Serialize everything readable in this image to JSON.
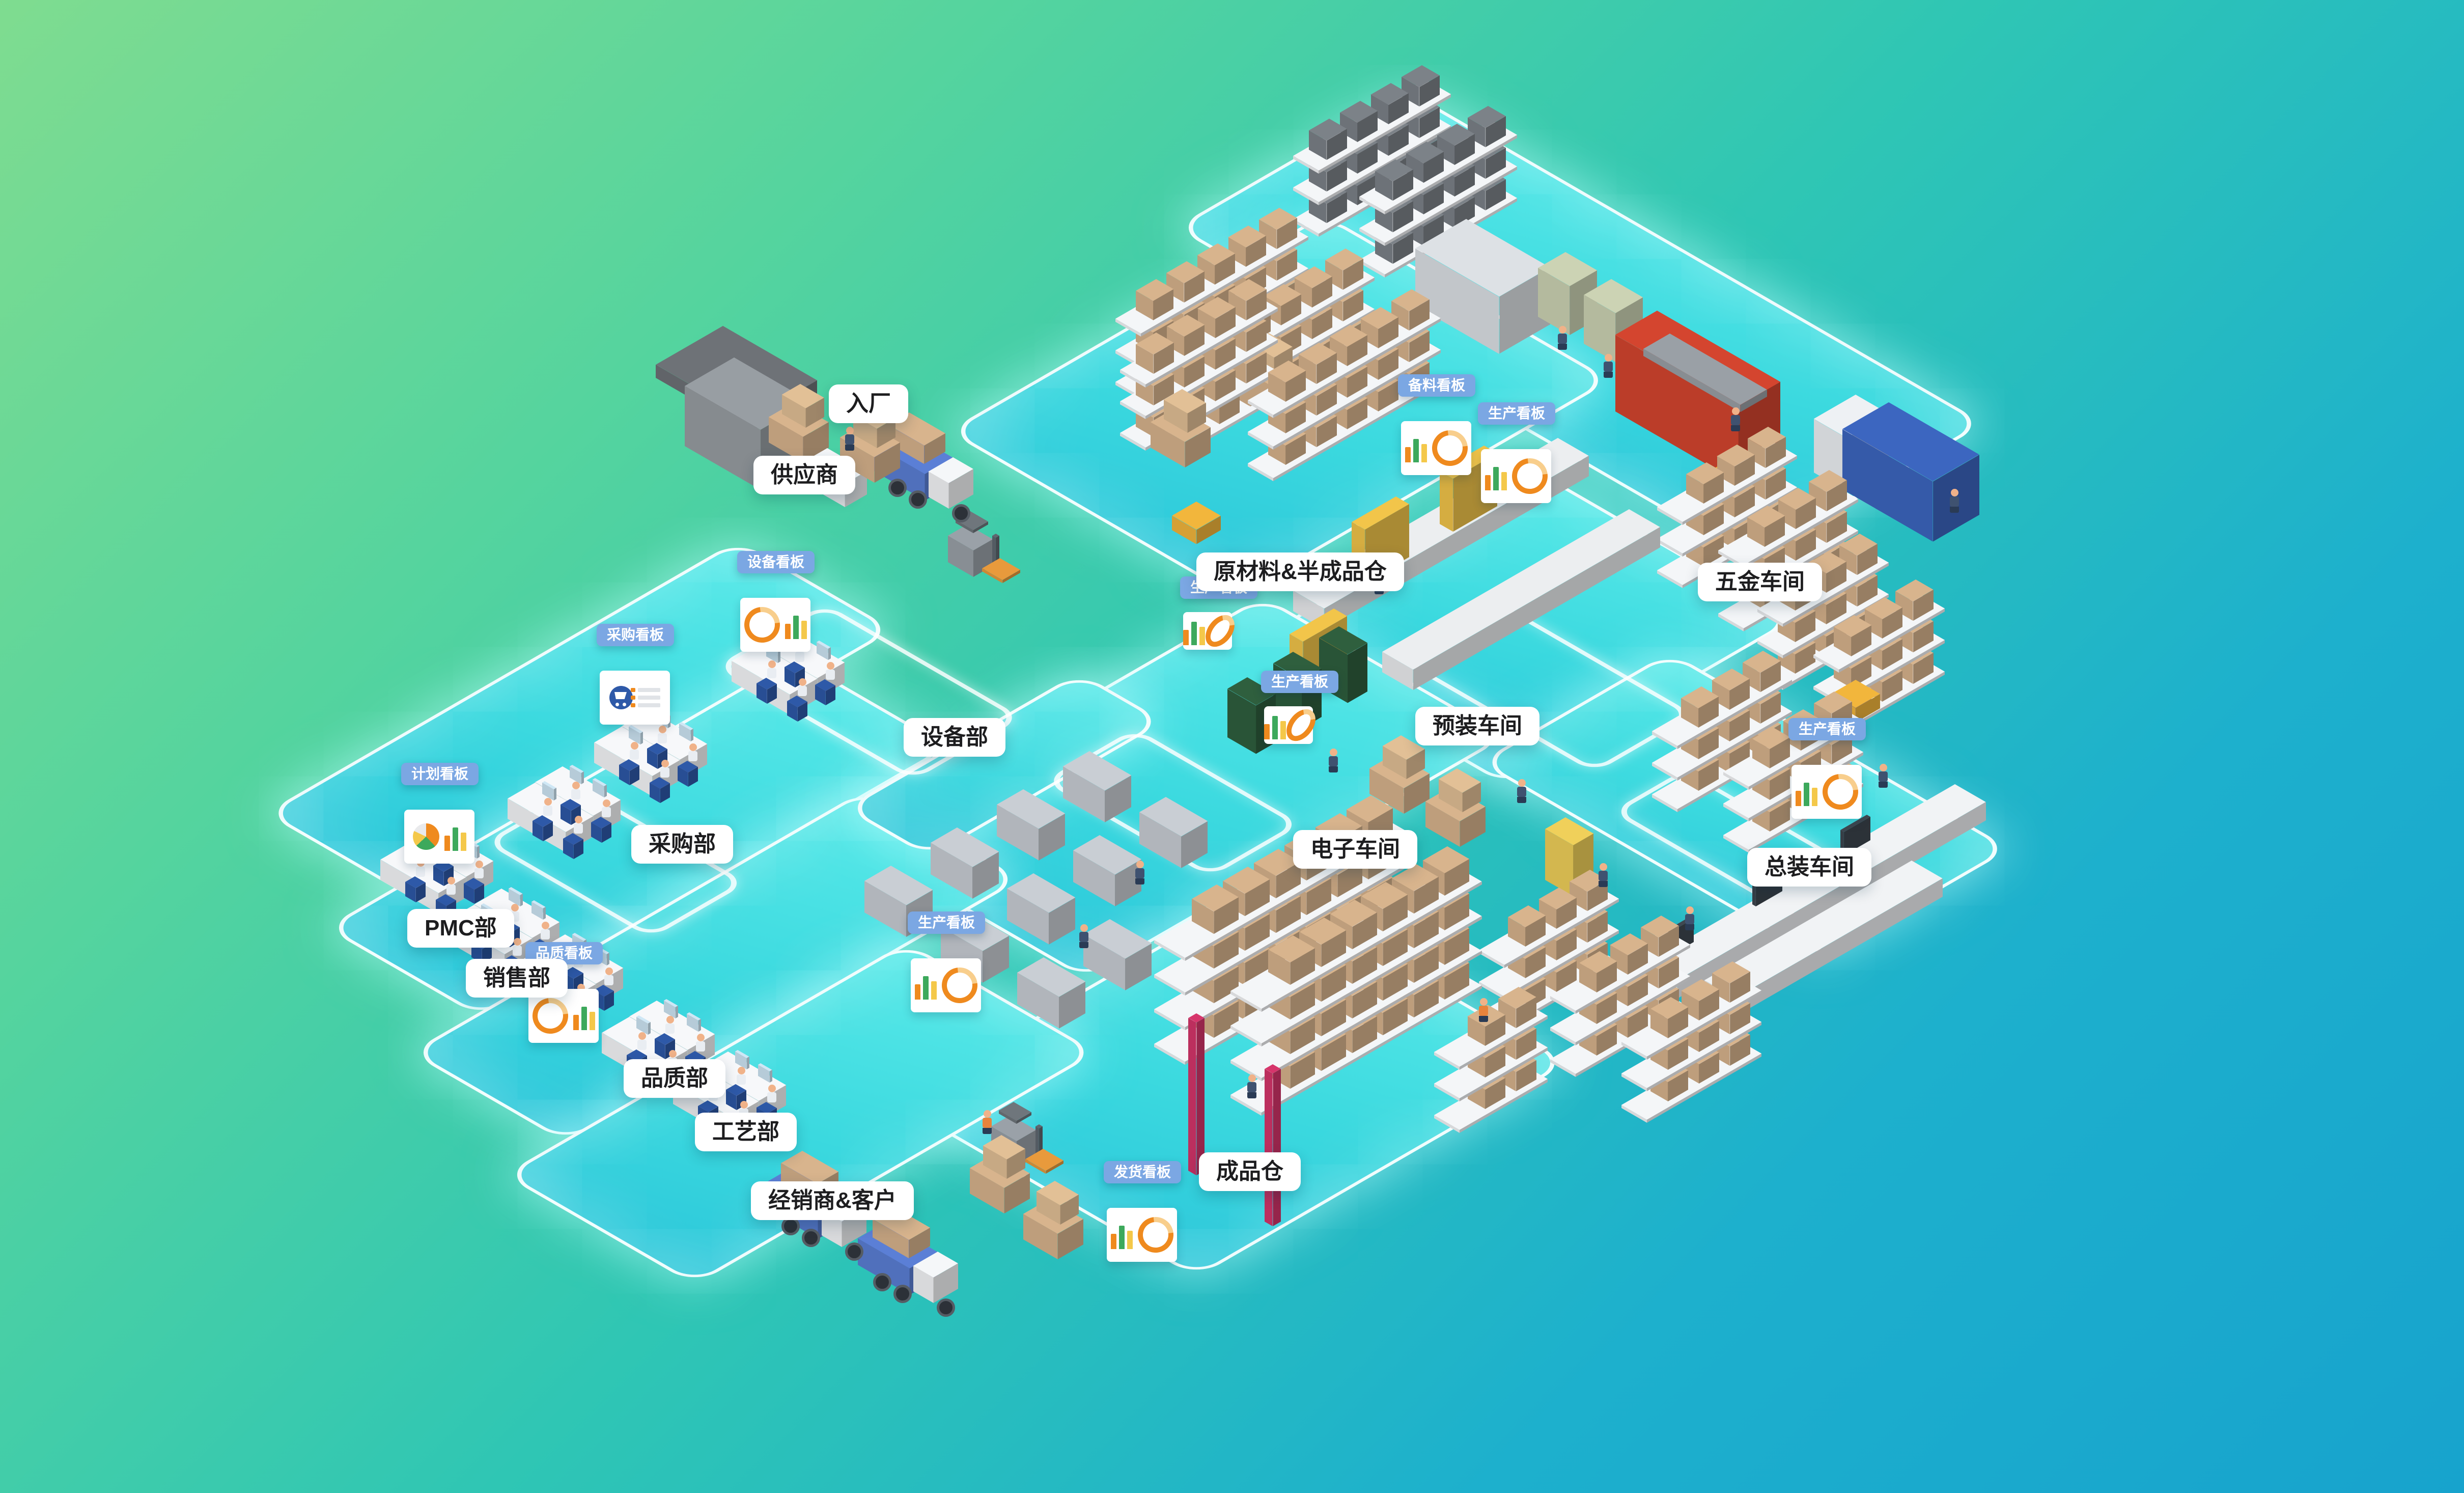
{
  "scene_title": "智能工厂全景图",
  "background": {
    "gradient_from": "#7FDC90",
    "gradient_mid": "#2FC6B4",
    "gradient_to": "#17A3CD"
  },
  "platform": {
    "fill": "#3BD9DF",
    "edge_glow": "#FFFFFF"
  },
  "labels": [
    {
      "id": "supplier",
      "text": "供应商"
    },
    {
      "id": "entry",
      "text": "入厂"
    },
    {
      "id": "raw-warehouse",
      "text": "原材料&半成品仓"
    },
    {
      "id": "hardware-workshop",
      "text": "五金车间"
    },
    {
      "id": "equipment-dept",
      "text": "设备部"
    },
    {
      "id": "purchasing-dept",
      "text": "采购部"
    },
    {
      "id": "pmc-dept",
      "text": "PMC部"
    },
    {
      "id": "sales-dept",
      "text": "销售部"
    },
    {
      "id": "quality-dept",
      "text": "品质部"
    },
    {
      "id": "process-dept",
      "text": "工艺部"
    },
    {
      "id": "dealer-customer",
      "text": "经销商&客户"
    },
    {
      "id": "finished-warehouse",
      "text": "成品仓"
    },
    {
      "id": "electronics-workshop",
      "text": "电子车间"
    },
    {
      "id": "preassembly-workshop",
      "text": "预装车间"
    },
    {
      "id": "assembly-workshop",
      "text": "总装车间"
    }
  ],
  "kanban_signs": [
    {
      "id": "plan-kanban",
      "text": "计划看板",
      "board": "pie-bar"
    },
    {
      "id": "purchase-kanban",
      "text": "采购看板",
      "board": "cart-list"
    },
    {
      "id": "equipment-kanban",
      "text": "设备看板",
      "board": "ring-bar"
    },
    {
      "id": "quality-kanban",
      "text": "品质看板",
      "board": "ring-bar"
    },
    {
      "id": "stock-prep-kanban",
      "text": "备料看板",
      "board": "bar-ring"
    },
    {
      "id": "production-kanban-1",
      "text": "生产看板",
      "board": "bar-ring"
    },
    {
      "id": "production-kanban-2",
      "text": "生产看板",
      "board": "bar-ring"
    },
    {
      "id": "production-kanban-3",
      "text": "生产看板",
      "board": "bar-ring"
    },
    {
      "id": "production-kanban-4",
      "text": "生产看板",
      "board": "bar-ring"
    },
    {
      "id": "production-kanban-5",
      "text": "生产看板",
      "board": "bar-ring"
    },
    {
      "id": "shipping-kanban",
      "text": "发货看板",
      "board": "bar-ring"
    }
  ],
  "colors": {
    "kanban_blue": "#7BA7E3",
    "label_text": "#1D1D1F",
    "carton_tan": "#D8B48D",
    "rack_white": "#F4F6F8",
    "machine_gray": "#C9CED4",
    "press_red": "#D4452F",
    "molder_blue": "#3C66C0",
    "press_green": "#CCD3B4",
    "pcb_green": "#2F5F3E",
    "agv_yellow": "#F2B63C",
    "gantry_yellow": "#F2C54A",
    "crane_crimson": "#D6356B",
    "truck_blue": "#5B7FD6",
    "chair_blue": "#2E59A8",
    "chart_orange": "#EF8A1E",
    "chart_green": "#3DA95C",
    "chart_yellow": "#F4C84A"
  }
}
